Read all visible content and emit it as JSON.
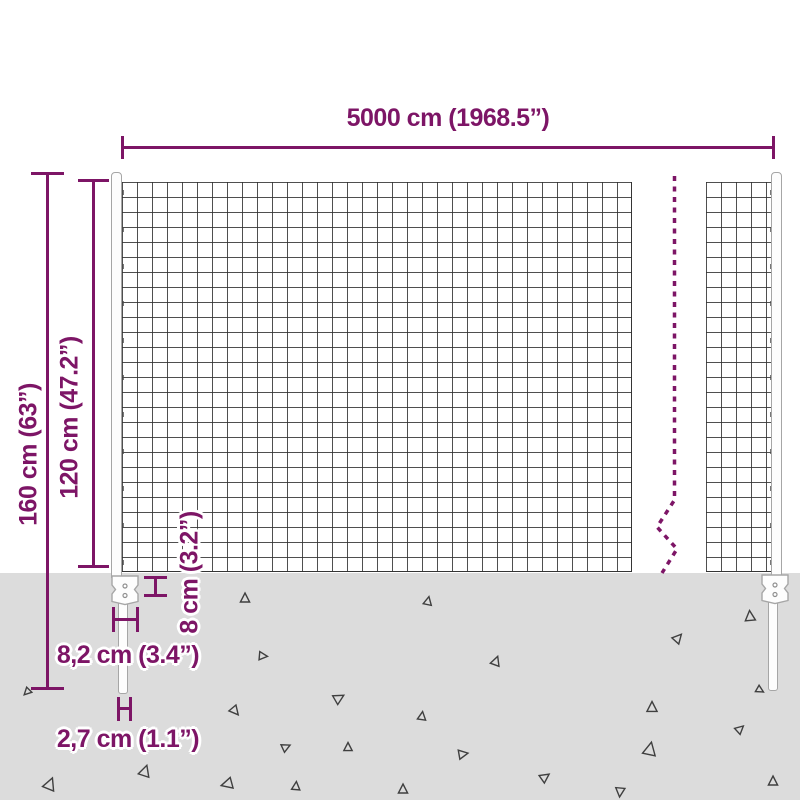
{
  "colors": {
    "accent": "#7d1566",
    "ground": "#dcdcdc",
    "mesh_line": "#3d3d3d",
    "post_fill": "#fdfdfd",
    "post_outline": "#a6a6a6",
    "triangle_outline": "#3f3f3f",
    "background": "#ffffff"
  },
  "dimensions": {
    "total_width": "5000 cm (1968.5”)",
    "total_height": "160 cm (63”)",
    "mesh_height": "120 cm (47.2”)",
    "anchor_depth": "8 cm (3.2”)",
    "anchor_plate_width": "8,2 cm (3.4”)",
    "post_diameter": "2,7 cm (1.1”)"
  },
  "ground": {
    "triangles": [
      {
        "x": 245,
        "y": 598,
        "s": 10,
        "r": 0
      },
      {
        "x": 428,
        "y": 601,
        "s": 9,
        "r": 12
      },
      {
        "x": 750,
        "y": 616,
        "s": 11,
        "r": 355
      },
      {
        "x": 263,
        "y": 656,
        "s": 9,
        "r": 95
      },
      {
        "x": 496,
        "y": 661,
        "s": 10,
        "r": 20
      },
      {
        "x": 678,
        "y": 638,
        "s": 10,
        "r": 42
      },
      {
        "x": 27,
        "y": 692,
        "s": 8,
        "r": 225
      },
      {
        "x": 235,
        "y": 711,
        "s": 10,
        "r": 140
      },
      {
        "x": 339,
        "y": 698,
        "s": 11,
        "r": 60
      },
      {
        "x": 422,
        "y": 716,
        "s": 9,
        "r": 8
      },
      {
        "x": 652,
        "y": 707,
        "s": 11,
        "r": 0
      },
      {
        "x": 286,
        "y": 747,
        "s": 9,
        "r": 65
      },
      {
        "x": 348,
        "y": 747,
        "s": 9,
        "r": 0
      },
      {
        "x": 463,
        "y": 754,
        "s": 10,
        "r": 80
      },
      {
        "x": 545,
        "y": 777,
        "s": 10,
        "r": 55
      },
      {
        "x": 650,
        "y": 749,
        "s": 14,
        "r": 12
      },
      {
        "x": 740,
        "y": 729,
        "s": 9,
        "r": 48
      },
      {
        "x": 773,
        "y": 781,
        "s": 10,
        "r": 0
      },
      {
        "x": 145,
        "y": 771,
        "s": 12,
        "r": 18
      },
      {
        "x": 50,
        "y": 784,
        "s": 13,
        "r": 22
      },
      {
        "x": 227,
        "y": 784,
        "s": 12,
        "r": 255
      },
      {
        "x": 296,
        "y": 786,
        "s": 9,
        "r": 5
      },
      {
        "x": 403,
        "y": 789,
        "s": 10,
        "r": 0
      },
      {
        "x": 620,
        "y": 792,
        "s": 10,
        "r": 185
      },
      {
        "x": 760,
        "y": 690,
        "s": 8,
        "r": 120
      }
    ]
  }
}
